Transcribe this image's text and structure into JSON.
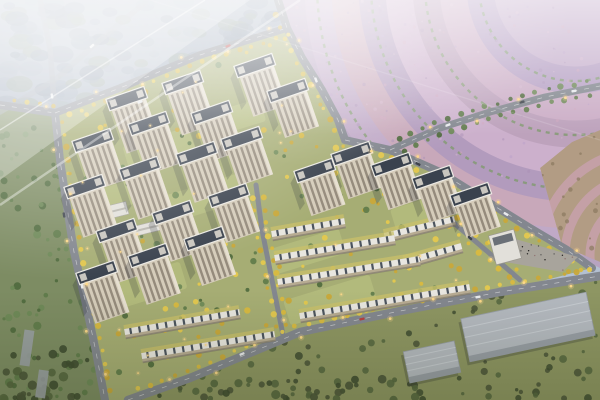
{
  "scene": {
    "description": "Dusk aerial architectural rendering of a residential development: beige high-rise towers and white-roof townhouse rows amid yellow autumn trees, ring road, purple flower-field terraces upper right, hazy forest upper left, olive tree fields and gray warehouses at bottom",
    "canvas": {
      "w": 600,
      "h": 400
    },
    "palette": {
      "haze_blue": "#b4c0d2",
      "forest_base": "#9fabbc",
      "forest_clumps": [
        "#7c8a9e",
        "#8695a9",
        "#8a9a92",
        "#93a1b2"
      ],
      "left_strip": "#7d8c63",
      "flower_base": "#bba6c6",
      "flower_bands": [
        "#c4adcb",
        "#b6a0c4",
        "#cbadc6",
        "#bda2bc",
        "#ccb0cc",
        "#b29bbd",
        "#c8a8ba",
        "#c0a9c7",
        "#b7a3c0",
        "#caaec4",
        "#bea6c0"
      ],
      "flower_green_line": "#7f9a6e",
      "tan_field": "#b29c84",
      "tan_arc": "#c9a2b2",
      "dev_ground": "#a6ad74",
      "courtyard": "#b8bf80",
      "road": "#83878f",
      "road_offsite": "#99a0ac",
      "road_line": "#e8e8e8",
      "tower_facade": "#d5ccba",
      "tower_facade_edge": "#e6dfd0",
      "tower_window": "#847b6d",
      "tower_roof": "#3a424e",
      "tower_roof_edge": "#eceae4",
      "tower_roof_block": "#c9c6bf",
      "townhouse_roof": "#e8e6e0",
      "townhouse_dark": "#4c545e",
      "townhouse_body": "#b7ab92",
      "townhouse_garden": "#c9c06a",
      "white_building": "#e2e0da",
      "plaza": "#a8a49c",
      "warehouse": "#b4b9c0",
      "warehouse_shade": "#979da5",
      "olive_field": "#8e9663",
      "tree_yellow": [
        "#d9b93f",
        "#e4c84e",
        "#c9a839"
      ],
      "tree_green": [
        "#5e7a49",
        "#6d8856",
        "#4f693d"
      ],
      "tree_dark": [
        "#4a5438",
        "#55663f",
        "#3f4c31"
      ],
      "light_warm": "#ffd98a",
      "car_white": "#e8eaec",
      "car_dark": "#3e444c",
      "car_red": "#b84040",
      "shadow": "rgba(30,35,50,0.22)"
    },
    "regions": {
      "forest": [
        [
          0,
          0
        ],
        [
          278,
          0
        ],
        [
          287,
          28
        ],
        [
          160,
          72
        ],
        [
          55,
          113
        ],
        [
          0,
          105
        ]
      ],
      "left_strip": [
        [
          0,
          105
        ],
        [
          55,
          113
        ],
        [
          60,
          160
        ],
        [
          66,
          200
        ],
        [
          74,
          252
        ],
        [
          85,
          300
        ],
        [
          96,
          352
        ],
        [
          105,
          400
        ],
        [
          0,
          400
        ]
      ],
      "flower": [
        [
          278,
          0
        ],
        [
          600,
          0
        ],
        [
          600,
          268
        ],
        [
          560,
          248
        ],
        [
          480,
          197
        ],
        [
          390,
          150
        ],
        [
          345,
          140
        ],
        [
          320,
          88
        ],
        [
          300,
          55
        ],
        [
          287,
          28
        ]
      ],
      "development": [
        [
          55,
          113
        ],
        [
          160,
          72
        ],
        [
          287,
          28
        ],
        [
          302,
          58
        ],
        [
          322,
          90
        ],
        [
          338,
          120
        ],
        [
          345,
          140
        ],
        [
          390,
          150
        ],
        [
          440,
          172
        ],
        [
          480,
          197
        ],
        [
          530,
          228
        ],
        [
          567,
          250
        ],
        [
          592,
          268
        ],
        [
          500,
          292
        ],
        [
          400,
          311
        ],
        [
          300,
          332
        ],
        [
          190,
          378
        ],
        [
          128,
          400
        ],
        [
          105,
          400
        ],
        [
          96,
          352
        ],
        [
          85,
          300
        ],
        [
          74,
          252
        ],
        [
          66,
          200
        ],
        [
          60,
          160
        ]
      ],
      "olive": [
        [
          128,
          400
        ],
        [
          190,
          378
        ],
        [
          300,
          332
        ],
        [
          400,
          311
        ],
        [
          500,
          292
        ],
        [
          600,
          276
        ],
        [
          600,
          400
        ]
      ],
      "tan_patch": [
        [
          540,
          168
        ],
        [
          572,
          142
        ],
        [
          600,
          130
        ],
        [
          600,
          262
        ],
        [
          562,
          246
        ]
      ]
    },
    "flower_rings": {
      "cx": 575,
      "cy": -15,
      "r0": 55,
      "step": 27,
      "count": 11,
      "green_radii": [
        96,
        150,
        204,
        258,
        312
      ],
      "tan_arcs": {
        "cx": 645,
        "cy": 255,
        "radii": [
          55,
          80,
          105
        ]
      }
    },
    "roads": [
      {
        "name": "offsite-road-northwest",
        "pts": [
          [
            40,
            0
          ],
          [
            50,
            48
          ],
          [
            55,
            113
          ]
        ],
        "w": 5.5,
        "dash": false,
        "lights": false,
        "trees": null,
        "op": 0.8,
        "offsite": true
      },
      {
        "name": "offsite-road-west",
        "pts": [
          [
            148,
            0
          ],
          [
            100,
            40
          ],
          [
            55,
            80
          ],
          [
            0,
            112
          ]
        ],
        "w": 5.5,
        "dash": false,
        "lights": false,
        "trees": null,
        "op": 0.55,
        "offsite": true
      },
      {
        "name": "west-boulevard",
        "pts": [
          [
            0,
            105
          ],
          [
            55,
            113
          ],
          [
            60,
            160
          ],
          [
            66,
            200
          ],
          [
            74,
            252
          ],
          [
            85,
            300
          ],
          [
            96,
            352
          ],
          [
            105,
            400
          ]
        ],
        "w": 8,
        "dash": true,
        "lights": true,
        "trees": "yellow",
        "treeOff": -7,
        "op": 1
      },
      {
        "name": "north-ring-road",
        "pts": [
          [
            55,
            113
          ],
          [
            120,
            88
          ],
          [
            200,
            55
          ],
          [
            287,
            28
          ]
        ],
        "w": 7.5,
        "dash": true,
        "lights": true,
        "trees": "yellow",
        "treeOff": 7,
        "op": 1
      },
      {
        "name": "east-ring-road",
        "pts": [
          [
            278,
            0
          ],
          [
            287,
            28
          ],
          [
            302,
            58
          ],
          [
            322,
            90
          ],
          [
            338,
            120
          ],
          [
            345,
            140
          ],
          [
            390,
            150
          ],
          [
            440,
            172
          ],
          [
            480,
            197
          ],
          [
            530,
            228
          ],
          [
            567,
            250
          ],
          [
            592,
            268
          ]
        ],
        "w": 8,
        "dash": true,
        "lights": true,
        "trees": "yellow",
        "treeOff": 7,
        "op": 1
      },
      {
        "name": "flower-field-road",
        "pts": [
          [
            390,
            150
          ],
          [
            440,
            128
          ],
          [
            490,
            112
          ],
          [
            545,
            97
          ],
          [
            600,
            86
          ]
        ],
        "w": 7,
        "dash": true,
        "lights": true,
        "trees": "green",
        "treeOff": 6.5,
        "treeBoth": true,
        "op": 1
      },
      {
        "name": "south-boulevard",
        "pts": [
          [
            128,
            400
          ],
          [
            190,
            378
          ],
          [
            300,
            332
          ],
          [
            400,
            311
          ],
          [
            500,
            292
          ],
          [
            600,
            276
          ]
        ],
        "w": 8.5,
        "dash": true,
        "lights": true,
        "trees": "yellow",
        "treeOff": -7,
        "op": 1
      },
      {
        "name": "east-internal-road",
        "pts": [
          [
            425,
            195
          ],
          [
            455,
            224
          ],
          [
            488,
            252
          ],
          [
            520,
            280
          ]
        ],
        "w": 5,
        "dash": false,
        "lights": true,
        "trees": "yellow",
        "treeOff": 5.5,
        "treeBoth": true,
        "op": 1
      },
      {
        "name": "central-internal-road",
        "pts": [
          [
            256,
            185
          ],
          [
            262,
            230
          ],
          [
            272,
            280
          ],
          [
            283,
            335
          ]
        ],
        "w": 5,
        "dash": false,
        "lights": true,
        "trees": "yellow",
        "treeOff": 5.5,
        "treeBoth": true,
        "op": 1
      }
    ],
    "towers": {
      "rotation": -19,
      "roof_w": 40,
      "roof_h": 12,
      "body_w": 36,
      "list": [
        [
          130,
          108,
          46
        ],
        [
          186,
          92,
          44
        ],
        [
          258,
          75,
          42
        ],
        [
          291,
          100,
          38
        ],
        [
          96,
          150,
          42
        ],
        [
          152,
          133,
          42
        ],
        [
          215,
          122,
          40
        ],
        [
          245,
          148,
          38
        ],
        [
          88,
          196,
          42
        ],
        [
          143,
          178,
          42
        ],
        [
          200,
          163,
          40
        ],
        [
          318,
          180,
          36
        ],
        [
          120,
          240,
          44
        ],
        [
          176,
          222,
          40
        ],
        [
          232,
          205,
          38
        ],
        [
          100,
          282,
          42
        ],
        [
          152,
          265,
          40
        ],
        [
          208,
          248,
          38
        ],
        [
          355,
          163,
          36
        ],
        [
          395,
          174,
          36
        ],
        [
          436,
          187,
          36
        ],
        [
          474,
          204,
          34
        ]
      ]
    },
    "townhouse_rows": [
      [
        272,
        236,
        345,
        223
      ],
      [
        275,
        260,
        395,
        240
      ],
      [
        278,
        284,
        420,
        261
      ],
      [
        300,
        318,
        470,
        289
      ],
      [
        125,
        334,
        240,
        314
      ],
      [
        142,
        358,
        275,
        336
      ],
      [
        385,
        238,
        455,
        221
      ],
      [
        405,
        264,
        462,
        248
      ]
    ],
    "buildings": {
      "white_slabs": [
        {
          "cx": 106,
          "cy": 213,
          "w": 44,
          "h": 13,
          "rot": -14
        },
        {
          "cx": 148,
          "cy": 228,
          "w": 28,
          "h": 10,
          "rot": -14
        },
        {
          "cx": 182,
          "cy": 214,
          "w": 20,
          "h": 8,
          "rot": -14
        }
      ],
      "commercial": {
        "cx": 505,
        "cy": 247,
        "w": 26,
        "h": 30,
        "rot": -15
      },
      "plaza": [
        [
          512,
          238
        ],
        [
          578,
          257
        ],
        [
          562,
          272
        ],
        [
          505,
          262
        ]
      ],
      "warehouses": [
        {
          "cx": 528,
          "cy": 327,
          "w": 128,
          "h": 44,
          "rot": -12
        },
        {
          "cx": 432,
          "cy": 362,
          "w": 52,
          "h": 32,
          "rot": -12
        }
      ],
      "park_slabs": [
        {
          "cx": 27,
          "cy": 348,
          "w": 10,
          "h": 36,
          "rot": 8
        },
        {
          "cx": 42,
          "cy": 384,
          "w": 10,
          "h": 28,
          "rot": 8
        }
      ]
    },
    "courtyards": [
      {
        "cx": 160,
        "cy": 150,
        "w": 70,
        "h": 28
      },
      {
        "cx": 235,
        "cy": 118,
        "w": 58,
        "h": 24
      },
      {
        "cx": 105,
        "cy": 200,
        "w": 56,
        "h": 24
      },
      {
        "cx": 205,
        "cy": 198,
        "w": 76,
        "h": 28
      },
      {
        "cx": 150,
        "cy": 285,
        "w": 70,
        "h": 28
      },
      {
        "cx": 330,
        "cy": 300,
        "w": 90,
        "h": 26
      },
      {
        "cx": 420,
        "cy": 212,
        "w": 56,
        "h": 22
      },
      {
        "cx": 305,
        "cy": 252,
        "w": 78,
        "h": 26
      }
    ],
    "cars": [
      {
        "x": 52,
        "y": 96,
        "a": 80,
        "c": "w"
      },
      {
        "x": 64,
        "y": 215,
        "a": 80,
        "c": "d"
      },
      {
        "x": 82,
        "y": 286,
        "a": 80,
        "c": "w"
      },
      {
        "x": 140,
        "y": 102,
        "a": -20,
        "c": "w"
      },
      {
        "x": 228,
        "y": 46,
        "a": -19,
        "c": "r"
      },
      {
        "x": 316,
        "y": 80,
        "a": 70,
        "c": "w"
      },
      {
        "x": 418,
        "y": 164,
        "a": 26,
        "c": "d"
      },
      {
        "x": 506,
        "y": 214,
        "a": 30,
        "c": "w"
      },
      {
        "x": 448,
        "y": 125,
        "a": -20,
        "c": "w"
      },
      {
        "x": 522,
        "y": 102,
        "a": -15,
        "c": "d"
      },
      {
        "x": 574,
        "y": 91,
        "a": -11,
        "c": "w"
      },
      {
        "x": 242,
        "y": 354,
        "a": -23,
        "c": "w"
      },
      {
        "x": 362,
        "y": 319,
        "a": -12,
        "c": "r"
      },
      {
        "x": 478,
        "y": 297,
        "a": -10,
        "c": "w"
      },
      {
        "x": 92,
        "y": 46,
        "a": -40,
        "c": "w"
      },
      {
        "x": 470,
        "y": 238,
        "a": 42,
        "c": "d"
      }
    ],
    "scatter": {
      "forest_clumps": 95,
      "left_strip_trees": 75,
      "olive_trees": 100,
      "corner_cluster": 45,
      "bottom_edge_trees": 35,
      "dev_yellow": 120,
      "dev_green": 60,
      "court_lights": 26,
      "flower_speckles": 130,
      "plaza_people": 18
    }
  }
}
